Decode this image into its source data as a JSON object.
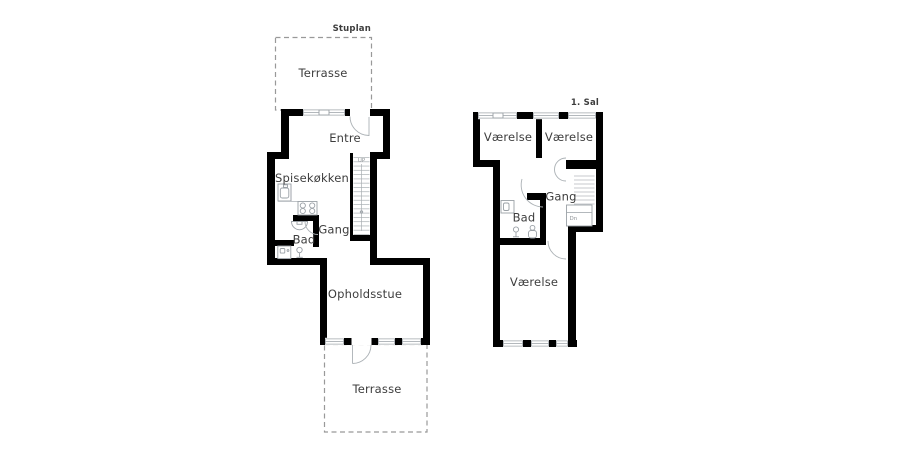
{
  "page": {
    "background": "#ffffff"
  },
  "colors": {
    "wall": "#000000",
    "fixture_line": "#9aa0a6",
    "stair_line": "#b4b9bc",
    "terrace_dash": "#999999",
    "label_text": "#3d3d3d"
  },
  "plans": {
    "ground": {
      "title": "Stuplan",
      "rooms": {
        "terrace_top": "Terrasse",
        "entre": "Entre",
        "kitchen": "Spisekøkken",
        "hall": "Gang",
        "bath": "Bad",
        "living": "Opholdsstue",
        "terrace_bottom": "Terrasse"
      },
      "stairs_label": "UP"
    },
    "first": {
      "title": "1. Sal",
      "rooms": {
        "bedroom_left": "Værelse",
        "bedroom_right": "Værelse",
        "hall": "Gang",
        "bath": "Bad",
        "bedroom_lower": "Værelse"
      },
      "stairs_label": "Dn"
    }
  }
}
